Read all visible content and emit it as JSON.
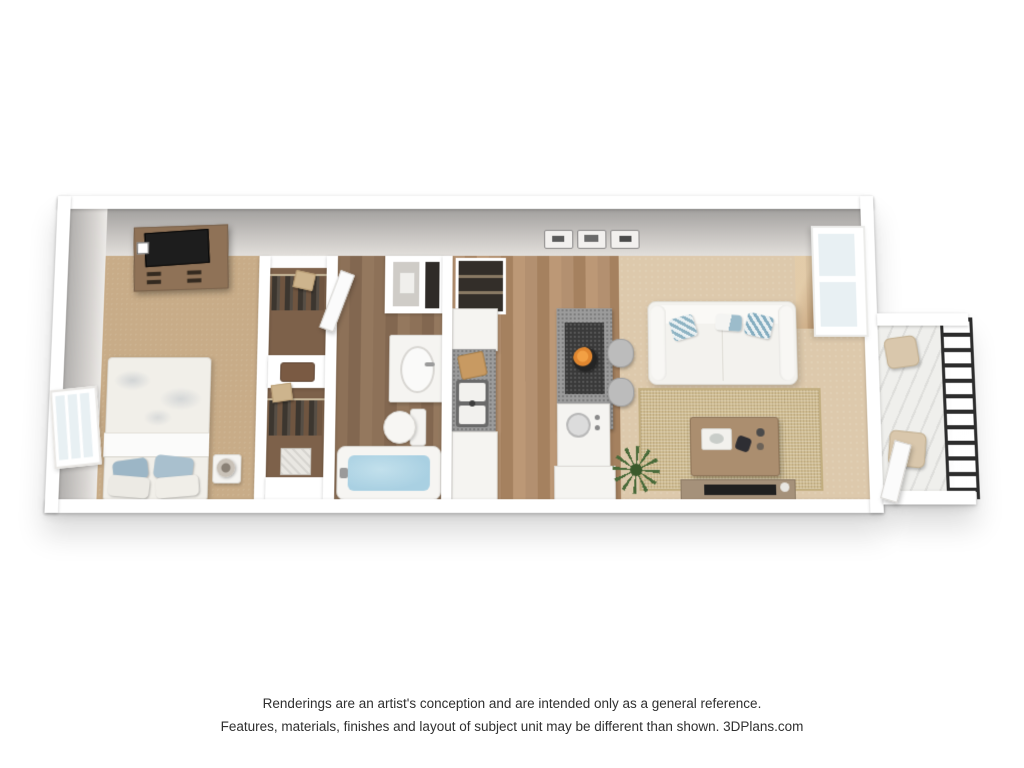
{
  "disclaimer": {
    "line1": "Renderings are an artist's conception and are intended only as a general reference.",
    "line2": "Features, materials, finishes and layout of subject unit may be different than shown. 3DPlans.com"
  },
  "floorplan": {
    "title": "one-bedroom apartment 3D floor plan rendering",
    "view": "3d-top-down",
    "rooms": [
      {
        "name": "bedroom",
        "floor": "tan carpet"
      },
      {
        "name": "walk-in-closets",
        "floor": "brown carpet"
      },
      {
        "name": "bathroom",
        "floor": "wood plank"
      },
      {
        "name": "kitchen",
        "floor": "wood plank"
      },
      {
        "name": "living-room",
        "floor": "beige carpet"
      },
      {
        "name": "balcony",
        "floor": "light concrete"
      }
    ],
    "furniture": {
      "bedroom": [
        "dresser-with-tv",
        "bed",
        "nightstand",
        "table-lamp",
        "window"
      ],
      "closets": [
        "hanging-clothes",
        "storage-boxes",
        "luggage-bench",
        "hamper"
      ],
      "bathroom": [
        "vanity-sink",
        "toilet",
        "bathtub",
        "linen-closet",
        "utility-shelves",
        "open-door"
      ],
      "kitchen": [
        "refrigerator",
        "cutting-board",
        "double-sink",
        "range",
        "breakfast-bar",
        "fruit-bowl",
        "bar-stools"
      ],
      "living_room": [
        "sofa",
        "throw-pillows",
        "area-rug",
        "coffee-table",
        "decor-tray",
        "tv-console",
        "television",
        "potted-plant",
        "wall-panels",
        "sliding-glass-door"
      ],
      "balcony": [
        "metal-railing",
        "patio-chairs",
        "open-door"
      ]
    },
    "colors": {
      "background": "#ffffff",
      "walls": "#ffffff",
      "wall_face_gray": "#a2a09e",
      "bedroom_carpet": "#c8ac88",
      "living_carpet": "#ddc9ac",
      "closet_carpet": "#7d614a",
      "bath_wood": "#8d7158",
      "kitchen_wood": "#ae8b69",
      "rug_jute": "#d0bd92",
      "counter_gray": "#9b9b9b",
      "bar_dark": "#3a3a3a",
      "sofa_white": "#f3f2ee",
      "pillow_blue": "#95b7c4",
      "tub_water": "#a9d0e2",
      "oranges": "#e0862f",
      "railing_black": "#2c2c2c",
      "wood_furniture": "#a98b6d",
      "dresser_wood": "#8f7257",
      "plant_green": "#4a6b3a",
      "text": "#2f2f2f"
    }
  }
}
